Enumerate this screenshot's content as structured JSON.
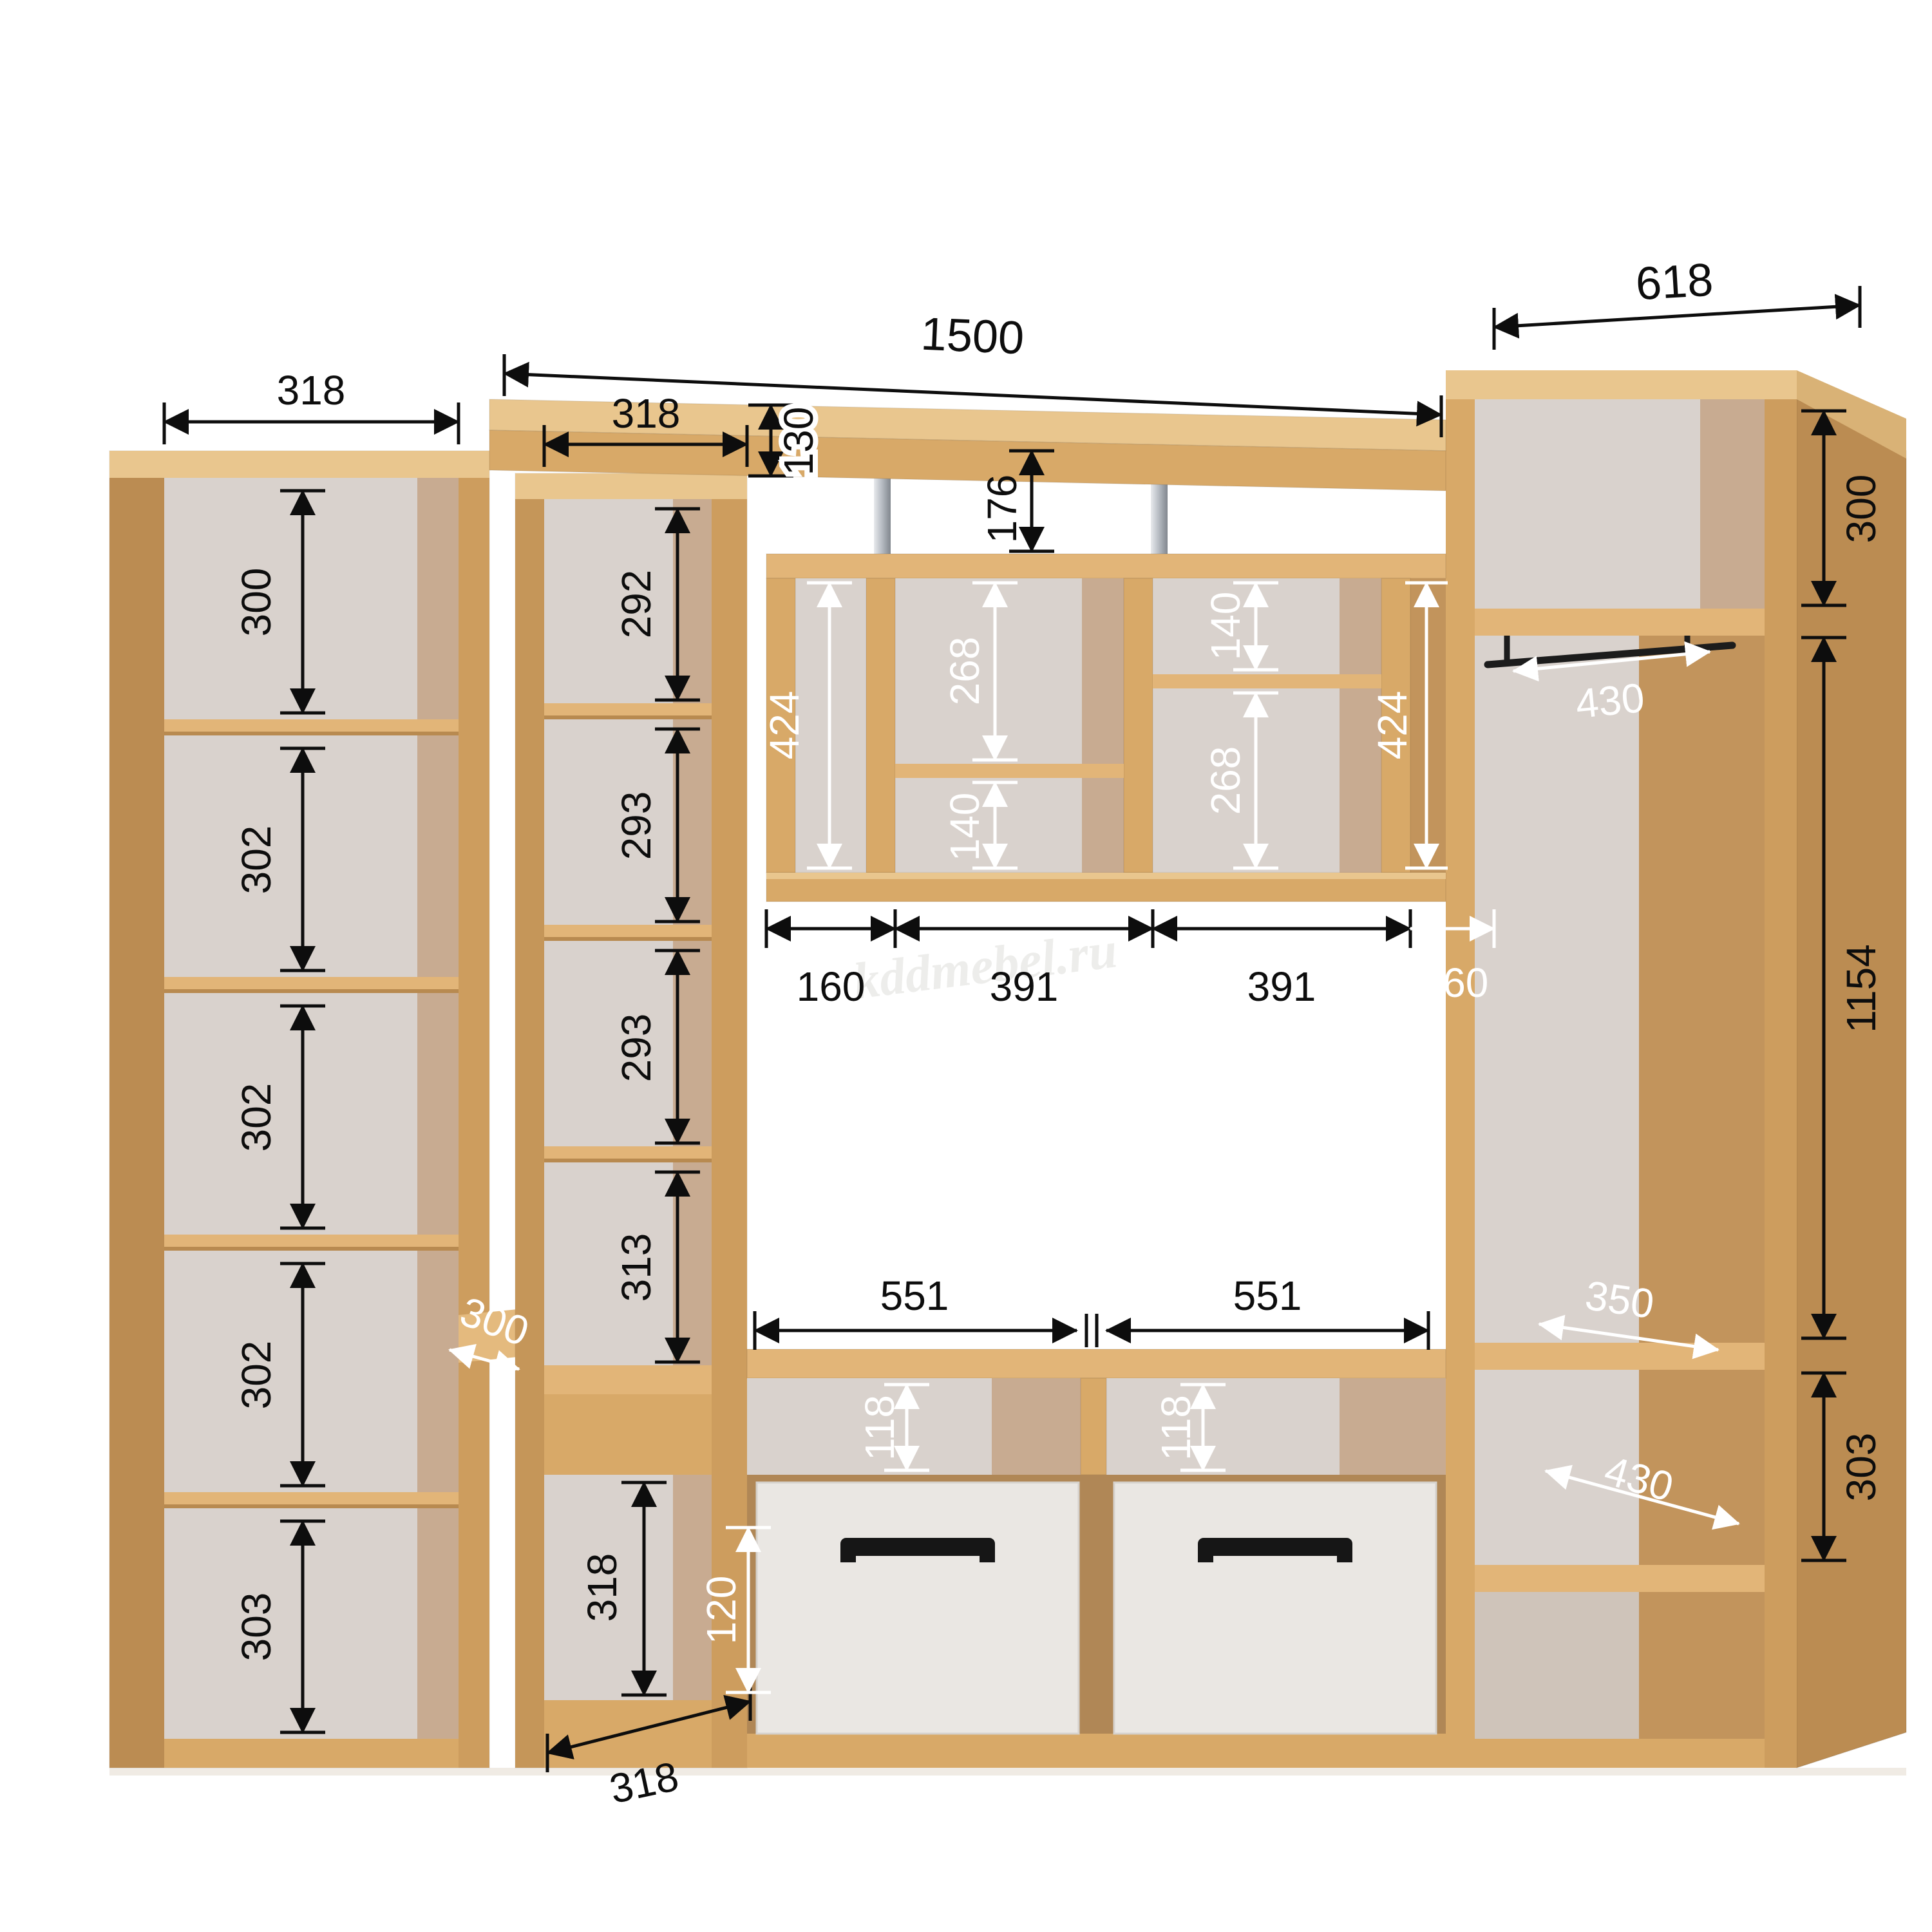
{
  "watermark": "kddmebel.ru",
  "colors": {
    "wood_front": "#d8a968",
    "wood_top": "#e9c68e",
    "wood_side": "#bb8c52",
    "back_panel": "#d9d2cd",
    "drawer_front": "#eae7e3",
    "handle": "#161616",
    "dim_black": "#0d0d0d",
    "dim_white": "#ffffff"
  },
  "dimensions": {
    "top_shelf": {
      "width": "1500",
      "height": "130",
      "gap_below": "176"
    },
    "left_bookcase": {
      "top_width": "318",
      "cells": [
        "300",
        "302",
        "302",
        "302",
        "303"
      ],
      "depth": "300"
    },
    "shelf_column": {
      "top_width": "318",
      "cells": [
        "292",
        "293",
        "293",
        "313",
        "318"
      ],
      "bottom_width": "318"
    },
    "wall_shelves": {
      "left_height": "424",
      "mid_top": "268",
      "mid_bottom": "140",
      "right_top": "140",
      "right_bottom": "268",
      "right_height": "424",
      "bottom_widths": [
        "160",
        "391",
        "391",
        "160"
      ]
    },
    "wardrobe": {
      "top_width": "618",
      "top_cell_height": "300",
      "rail_depth": "430",
      "side_height": "1154",
      "shelf_depth": "350",
      "lower_cell_height": "303",
      "bottom_depth": "430"
    },
    "tv_bench": {
      "left_width": "551",
      "right_width": "551",
      "left_niche_height": "118",
      "right_niche_height": "118",
      "drawer_offset": "120"
    }
  }
}
